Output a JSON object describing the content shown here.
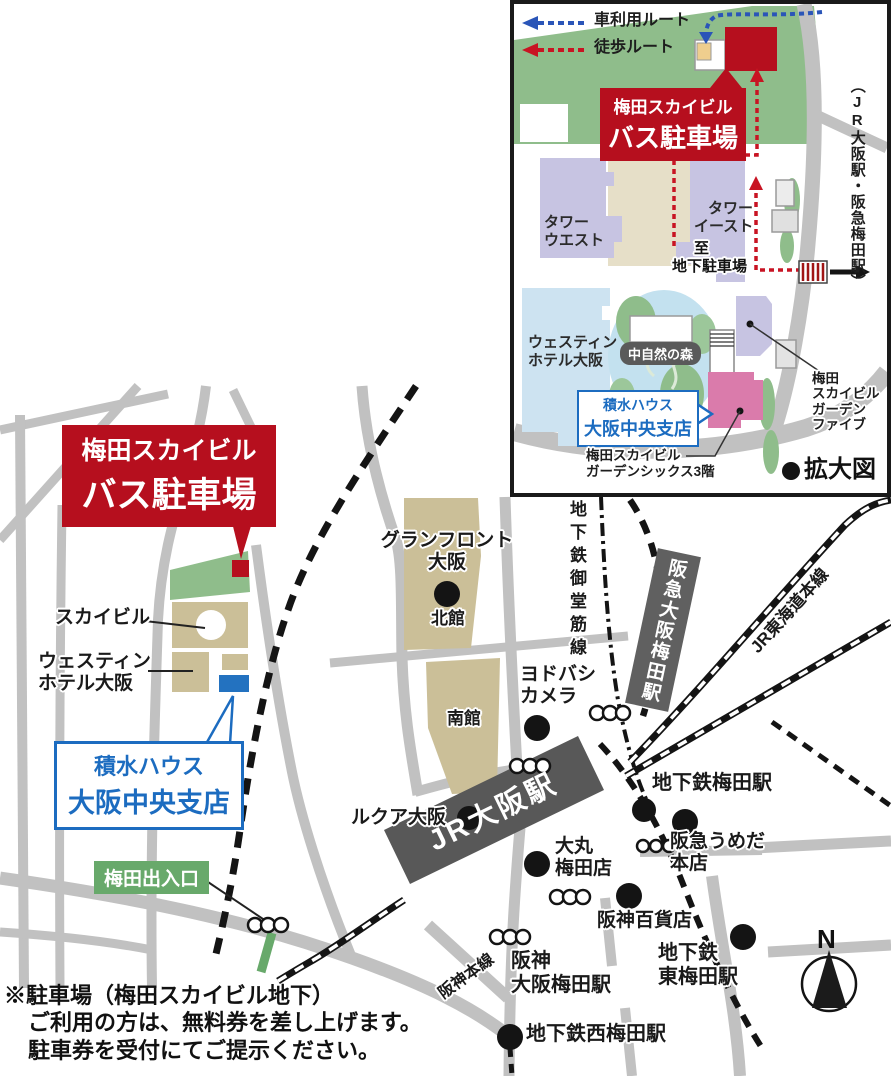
{
  "colors": {
    "road": "#c1c1c1",
    "green_area": "#8fbd8b",
    "tan_building": "#cbbf98",
    "purple_building": "#c7c4e2",
    "pink_building": "#da7bab",
    "blue_building": "#2372c0",
    "lightblue_building": "#cde3f1",
    "red_accent": "#b60f1e",
    "car_route_blue": "#2a55b8",
    "walk_route_red": "#c81423",
    "station_dark": "#585858",
    "exit_green": "#68a96b",
    "sekisui_blue": "#1c6cc0"
  },
  "inset": {
    "legend": {
      "car_route": "車利用ルート",
      "walk_route": "徒歩ルート"
    },
    "banner": {
      "line1": "梅田スカイビル",
      "line2": "バス駐車場"
    },
    "labels": {
      "tower_west": "タワー\nウエスト",
      "tower_east": "タワー\nイースト",
      "to_underground_parking": "至\n地下駐車場",
      "jr_hankyu_stations": "（JR大阪駅・阪急梅田駅）",
      "westin_hotel": "ウェスティン\nホテル大阪",
      "nature_forest": "中自然の森",
      "sekisui_line1": "積水ハウス",
      "sekisui_line2": "大阪中央支店",
      "garden_five": "梅田\nスカイビル\nガーデン\nファイブ",
      "garden_six": "梅田スカイビル\nガーデンシックス3階",
      "enlarged_map": "拡大図"
    }
  },
  "main": {
    "banner": {
      "line1": "梅田スカイビル",
      "line2": "バス駐車場"
    },
    "sekisui": {
      "line1": "積水ハウス",
      "line2": "大阪中央支店"
    },
    "labels": {
      "sky_building": "スカイビル",
      "westin_hotel": "ウェスティン\nホテル大阪",
      "umeda_exit": "梅田出入口",
      "grand_front_osaka": "グランフロント\n大阪",
      "north_building": "北館",
      "south_building": "南館",
      "yodobashi_camera": "ヨドバシ\nカメラ",
      "lucua_osaka": "ルクア大阪",
      "jr_osaka_station": "JR大阪駅",
      "daimaru_umeda": "大丸\n梅田店",
      "subway_midosuji_line": "地下鉄御堂筋線",
      "hankyu_osaka_umeda_station": "阪急大阪梅田駅",
      "jr_tokaido_main_line": "JR東海道本線",
      "subway_umeda_station": "地下鉄梅田駅",
      "hankyu_umeda_main_store": "阪急うめだ\n本店",
      "hanshin_department_store": "阪神百貨店",
      "hanshin_osaka_umeda_station": "阪神\n大阪梅田駅",
      "subway_higashi_umeda_station": "地下鉄\n東梅田駅",
      "subway_nishi_umeda_station": "地下鉄西梅田駅",
      "hanshin_main_line": "阪神本線",
      "compass_north": "N"
    },
    "note": {
      "line1": "※駐車場（梅田スカイビル地下）",
      "line2": "ご利用の方は、無料券を差し上げます。",
      "line3": "駐車券を受付にてご提示ください。"
    }
  }
}
